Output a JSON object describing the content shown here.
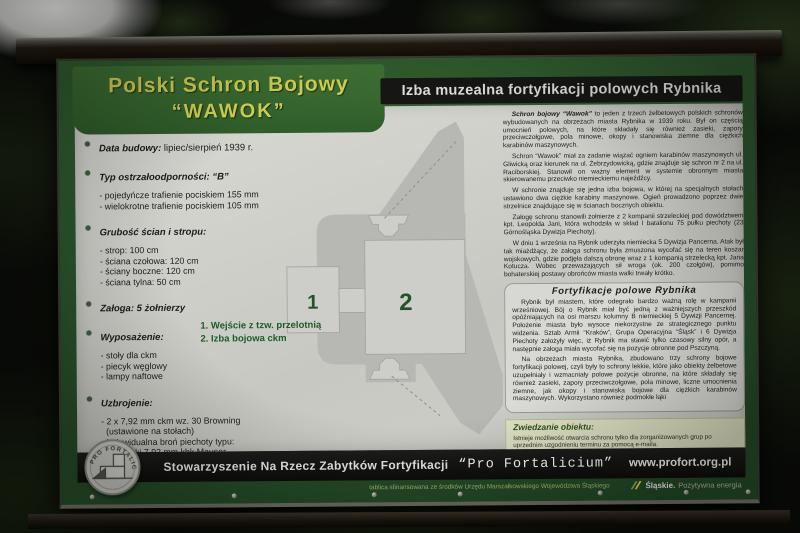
{
  "sign": {
    "header_left": {
      "line1": "Polski Schron Bojowy",
      "line2": "“WAWOK”"
    },
    "header_right": {
      "title": "Izba muzealna fortyfikacji polowych Rybnika"
    },
    "left_column": {
      "items": [
        {
          "label": "Data budowy:",
          "rest": " lipiec/sierpień 1939 r.",
          "details": []
        },
        {
          "label": "Typ ostrzałoodporności: “B”",
          "rest": "",
          "details": [
            "- pojedyńcze trafienie pociskiem 155 mm",
            "- wielokrotne trafienie pociskiem 105 mm"
          ]
        },
        {
          "label": "Grubość ścian i stropu:",
          "rest": "",
          "details": [
            "- strop: 100 cm",
            "- ściana czołowa: 120 cm",
            "- ściany boczne: 120 cm",
            "- ściana tylna: 50 cm"
          ]
        },
        {
          "label": "Załoga: 5 żołnierzy",
          "rest": "",
          "details": []
        },
        {
          "label": "Wyposażenie:",
          "rest": "",
          "details": [
            "- stoły dla ckm",
            "- piecyk węglowy",
            "- lampy naftowe"
          ]
        },
        {
          "label": "Uzbrojenie:",
          "rest": "",
          "details": [
            "- 2 x 7,92 mm ckm wz. 30 Browning",
            "  (ustawione na stołach)",
            "- indywidualna broń piechoty typu:",
            "  karabinki 7,92 mm kbk Mauser",
            "- granaty ręczne"
          ]
        }
      ]
    },
    "diagram": {
      "room_labels": [
        "1",
        "2"
      ],
      "legend": [
        "1. Wejście z tzw. przelotnią",
        "2. Izba bojowa ckm"
      ]
    },
    "right_column": {
      "p1_lead": "Schron bojowy “Wawok”",
      "p1_rest": " to jeden z trzech żelbetowych polskich schronów wybudowanych na obrzeżach miasta Rybnika w 1939 roku. Był on częścią umocnień polowych, na które składały się również zasieki, zapory przeciwczołgowe, pola minowe, okopy i stanowiska ziemne dla ciężkich karabinów maszynowych.",
      "paragraphs": [
        "Schron “Wawok” miał za zadanie wiązać ogniem karabinów maszynowych ul. Gliwicką oraz kierunek na ul. Żebrzydowicką, gdzie znajduje się schron nr 2 na ul. Raciborskiej. Stanowił on ważny element w systemie obronnym miasta skierowanemu przeciwko niemieckiemu najeźdźcy.",
        "W schronie znajduje się jedna izba bojowa, w której na specjalnych stołach ustawiono dwa ciężkie karabiny maszynowe. Ogień prowadzono poprzez dwie strzelnice znajdujące się w ścianach bocznych obiektu.",
        "Załogę schronu stanowili żołnierze z 2 kompanii strzeleckiej pod dowództwem kpt. Leopolda Jani, która wchodziła w skład I batalionu 75 pułku piechoty (23 Górnośląska Dywizja Piechoty).",
        "W dniu 1 września na Rybnik uderzyła niemiecka 5 Dywizja Pancerna. Atak był tak miażdżący, że załoga schronu była zmuszona wycofać się na teren koszar wojskowych, gdzie podjęła dalszą obronę wraz z 1 kompanią strzelecką kpt. Jana Kotucza. Wobec przeważających sił wroga (ok. 200 czołgów), pomimo bohaterskiej postawy obrońców miasta walki trwały krótko."
      ],
      "fort_box": {
        "title": "Fortyfikacje polowe Rybnika",
        "paragraphs": [
          "Rybnik był miastem, które odegrało bardzo ważną rolę w kampanii wrześniowej. Bój o Rybnik miał być jedną z ważniejszych przeszkód opóźniających na osi marszu kolumny B niemieckiej 5 Dywizji Pancernej. Położenie miasta było wysoce niekorzystne ze strategicznego punktu widzenia. Sztab Armii “Kraków”, Grupa Operacyjna “Śląsk” i 6 Dywizja Piechoty założyły więc, iż Rybnik ma stawić tylko czasowy silny opór, a następnie załoga miała wycofać się na pozycje obronne pod Pszczyną.",
          "Na obrzeżach miasta Rybnika, zbudowano trzy schrony bojowe fortyfikacji polowej, czyli były to schrony lekkie, które jako obiekty żelbetowe uzupełniały i wzmacniały polowe pozycje obronne, na które składały się również zasieki, zapory przeciwczołgowe, pola minowe, liczne umocnienia ziemne, jak okopy i stanowiska bojowe dla ciężkich karabinów maszynowych. Wykorzystano również podmokłe łąki"
        ]
      },
      "visit_box": {
        "title": "Zwiedzanie obiektu:",
        "line1": "Istnieje możliwość otwarcia schronu tylko dla zorganizowanych grup po uprzednim uzgodnieniu terminu za pomocą e-maila.",
        "care_label": "Opieka nad schronem:",
        "care_text": " rybnickie koło terenowe Stowarzyszenia “Pro Fortalicium”",
        "contact_label": "Kontakt:",
        "contact_text": " rybnik@profort.org.pl",
        "sticker": "www.zapomniany.rybnik.pl"
      }
    },
    "footer": {
      "org": "Stowarzyszenie Na Rzecz Zabytków Fortyfikacji",
      "org_quote": "“Pro Fortalicium”",
      "website": "www.profort.org.pl",
      "logo_text": "PRO FORTALICIUM",
      "funding_note": "tablica sfinansowana ze środków Urzędu Marszałkowskiego Województwa Śląskiego",
      "silesia_brand": "Śląskie.",
      "silesia_tagline": "Pozytywna energia"
    },
    "colors": {
      "board_green": "#2d5629",
      "header_yellow": "#d2d352",
      "panel_gray": "#d2d2cc",
      "footer_black": "#141412",
      "legend_green": "#1c5c2b",
      "visit_box_bg": "#dfe2c3"
    }
  }
}
